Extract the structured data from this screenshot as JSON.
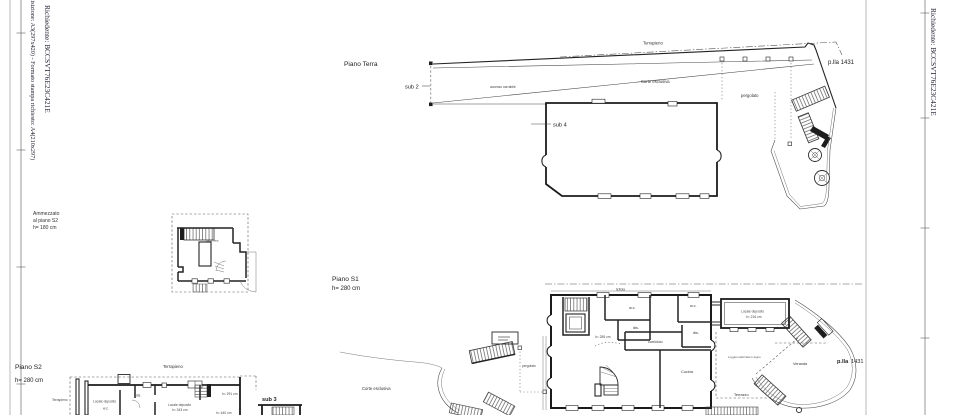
{
  "sheet": {
    "background": "#ffffff",
    "line_color": "#1b1b1b",
    "left_format_note": "Acquisizione: A3(297x420)  -  Formato stampa richiesto: A4(210x297)",
    "left_requester": "Richiedente: BCCSVT76E23C421E",
    "right_requester": "Richiedente: BCCSVT76E23C421E"
  },
  "mezzanine": {
    "note_line1": "Ammezzato",
    "note_line2": "al piano S2",
    "note_line3": "h= 180 cm",
    "room_label": "balconata"
  },
  "piano_terra": {
    "title": "Piano Terra",
    "sub2": "sub 2",
    "sub4": "sub 4",
    "accesso": "accesso carrabile",
    "terrapieno": "Terrapieno",
    "corte": "Corte esclusiva",
    "pergolato": "pergolato",
    "particella": "p.lla 1431"
  },
  "piano_s1": {
    "title": "Piano S1",
    "height": "h= 280 cm",
    "tettoia": "tettoia",
    "wc_left": "w.c.",
    "dis_left": "dis.",
    "h285": "h= 285 cm",
    "corridoio": "corridoio",
    "wc_right": "w.c.",
    "dis_right": "dis.",
    "cucina": "Cucina",
    "deposito_line1": "Locale deposito",
    "deposito_line2": "h= 216 cm",
    "loggia": "Loggia realizzata in legno",
    "veranda": "Veranda",
    "terrazzo": "Terrazzo",
    "pergolato": "pergolato",
    "corte": "Corte esclusiva",
    "particella_label": "p.lla",
    "particella_num": "1431"
  },
  "piano_s2": {
    "title": "Piano S2",
    "height": "h= 280 cm",
    "terrapieno_top": "Terrapieno",
    "terrapieno_left": "Terrapieno",
    "deposito_a": "Locale deposito",
    "wc": "w.c.",
    "dis": "dis.",
    "deposito_b_line1": "Locale deposito",
    "deposito_b_line2": "h= 343 cm",
    "h440": "h= 440 cm",
    "h291": "h= 291 cm",
    "sub3": "sub 3"
  }
}
